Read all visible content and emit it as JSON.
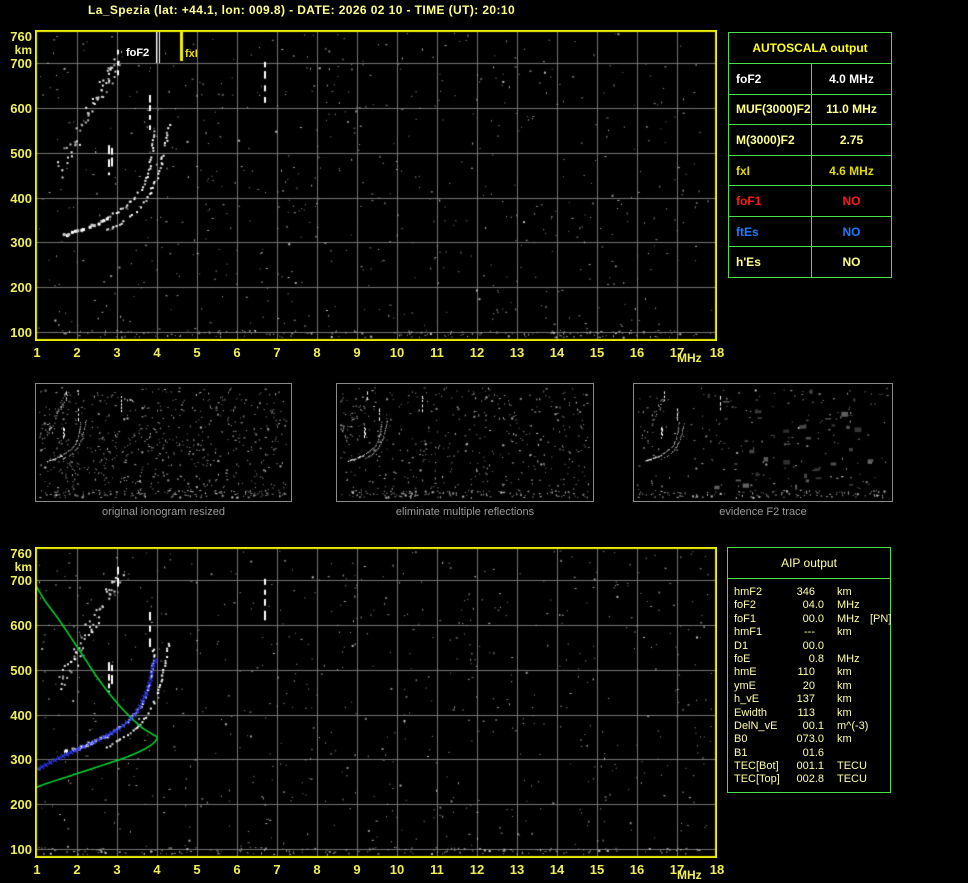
{
  "title": "La_Spezia (lat: +44.1, lon: 009.8) - DATE: 2026 02 10 - TIME (UT): 20:10",
  "colors": {
    "background": "#000000",
    "title_text": "#ffff8c",
    "plot_border": "#f0f000",
    "grid": "#757575",
    "axis_labels": "#f0f055",
    "table_border": "#49e049",
    "autoscala_header": "#ffff1a",
    "aip_text": "#ffffa6",
    "trace_white": "#ffffff",
    "profile_green": "#00dc32",
    "fit_blue": "#2f3cff",
    "caption_gray": "#9a9a9a"
  },
  "autoscala": {
    "header": "AUTOSCALA output",
    "rows": [
      {
        "label": "foF2",
        "value": "4.0 MHz",
        "color": "#ffffff"
      },
      {
        "label": "MUF(3000)F2",
        "value": "11.0 MHz",
        "color": "#ffff8c"
      },
      {
        "label": "M(3000)F2",
        "value": "2.75",
        "color": "#ffff8c"
      },
      {
        "label": "fxI",
        "value": "4.6 MHz",
        "color": "#e2d800"
      },
      {
        "label": "foF1",
        "value": "NO",
        "color": "#ff1a1a"
      },
      {
        "label": "ftEs",
        "value": "NO",
        "color": "#1e7bff"
      },
      {
        "label": "h'Es",
        "value": "NO",
        "color": "#ffff8c"
      }
    ]
  },
  "aip": {
    "header": "AIP output",
    "rows": [
      {
        "label": "hmF2",
        "value": "346",
        "unit": "km",
        "note": "",
        "pad": true
      },
      {
        "label": "foF2",
        "value": "04.0",
        "unit": "MHz",
        "note": "",
        "pad": false
      },
      {
        "label": "foF1",
        "value": "00.0",
        "unit": "MHz",
        "note": "[PN]",
        "pad": false
      },
      {
        "label": "hmF1",
        "value": "---",
        "unit": "km",
        "note": "",
        "pad": true
      },
      {
        "label": "D1",
        "value": "00.0",
        "unit": "",
        "note": "",
        "pad": false
      },
      {
        "label": "foE",
        "value": "0.8",
        "unit": "MHz",
        "note": "",
        "pad": false
      },
      {
        "label": "hmE",
        "value": "110",
        "unit": "km",
        "note": "",
        "pad": true
      },
      {
        "label": "ymE",
        "value": "20",
        "unit": "km",
        "note": "",
        "pad": true
      },
      {
        "label": "h_vE",
        "value": "137",
        "unit": "km",
        "note": "",
        "pad": true
      },
      {
        "label": "Ewidth",
        "value": "113",
        "unit": "km",
        "note": "",
        "pad": true
      },
      {
        "label": "DelN_vE",
        "value": "00.1",
        "unit": "m^(-3)",
        "note": "",
        "pad": false
      },
      {
        "label": "B0",
        "value": "073.0",
        "unit": "km",
        "note": "",
        "pad": false
      },
      {
        "label": "B1",
        "value": "01.6",
        "unit": "",
        "note": "",
        "pad": false
      },
      {
        "label": "TEC[Bot]",
        "value": "001.1",
        "unit": "TECU",
        "note": "",
        "pad": false
      },
      {
        "label": "TEC[Top]",
        "value": "002.8",
        "unit": "TECU",
        "note": "",
        "pad": false
      }
    ]
  },
  "thumbnails": [
    {
      "caption": "original ionogram resized"
    },
    {
      "caption": "eliminate multiple reflections"
    },
    {
      "caption": "evidence F2 trace"
    }
  ],
  "chart_data": {
    "type": "scatter",
    "title": "ionogram (virtual height vs sounding frequency)",
    "xlabel": "MHz",
    "ylabel": "km",
    "x_axis": {
      "label": "MHz",
      "ticks": [
        1,
        2,
        3,
        4,
        5,
        6,
        7,
        8,
        9,
        10,
        11,
        12,
        13,
        14,
        15,
        16,
        17,
        18
      ],
      "min": 1,
      "max": 18
    },
    "y_axis": {
      "label": "km",
      "ticks": [
        760,
        700,
        600,
        500,
        400,
        300,
        200,
        100
      ],
      "min": 80,
      "max": 773
    },
    "grid": true,
    "o_trace": [
      [
        1.6,
        317
      ],
      [
        2.1,
        332
      ],
      [
        2.6,
        350
      ],
      [
        2.95,
        368
      ],
      [
        3.25,
        388
      ],
      [
        3.5,
        410
      ],
      [
        3.65,
        433
      ],
      [
        3.75,
        457
      ],
      [
        3.83,
        488
      ],
      [
        3.88,
        522
      ],
      [
        3.9,
        551
      ]
    ],
    "x_trace": [
      [
        2.65,
        328
      ],
      [
        3.08,
        346
      ],
      [
        3.38,
        366
      ],
      [
        3.6,
        386
      ],
      [
        3.83,
        417
      ],
      [
        3.98,
        446
      ],
      [
        4.08,
        475
      ],
      [
        4.15,
        506
      ],
      [
        4.23,
        538
      ],
      [
        4.28,
        562
      ]
    ],
    "echo_streaks": [
      [
        3.03,
        673,
        730
      ],
      [
        2.8,
        450,
        517
      ],
      [
        2.88,
        462,
        511
      ],
      [
        3.83,
        551,
        629
      ],
      [
        6.7,
        607,
        703
      ]
    ],
    "multiple_reflection_band": {
      "from": [
        1.5,
        455
      ],
      "to": [
        3.05,
        720
      ]
    },
    "foF2_marker": {
      "freq": 4.0,
      "label": "foF2",
      "color": "#ffffff"
    },
    "fxI_marker": {
      "freq": 4.6,
      "label": "fxI",
      "color": "#f0e000"
    },
    "green_profile": [
      [
        0.95,
        692
      ],
      [
        1.2,
        654
      ],
      [
        1.57,
        609
      ],
      [
        2.07,
        542
      ],
      [
        2.57,
        475
      ],
      [
        3.07,
        419
      ],
      [
        3.57,
        375
      ],
      [
        3.87,
        357
      ],
      [
        4.0,
        348
      ],
      [
        3.82,
        330
      ],
      [
        3.32,
        308
      ],
      [
        2.57,
        285
      ],
      [
        1.82,
        263
      ],
      [
        1.2,
        245
      ],
      [
        0.95,
        236
      ]
    ],
    "blue_fit": [
      [
        1.03,
        279
      ],
      [
        1.55,
        303
      ],
      [
        2.08,
        325
      ],
      [
        2.57,
        345
      ],
      [
        3.07,
        370
      ],
      [
        3.45,
        401
      ],
      [
        3.7,
        441
      ],
      [
        3.83,
        475
      ],
      [
        3.9,
        508
      ],
      [
        3.97,
        524
      ]
    ],
    "aip_key_values": {
      "hmF2_km": 346,
      "foF2_MHz": 4.0,
      "foE_MHz": 0.8,
      "hmE_km": 110
    }
  }
}
